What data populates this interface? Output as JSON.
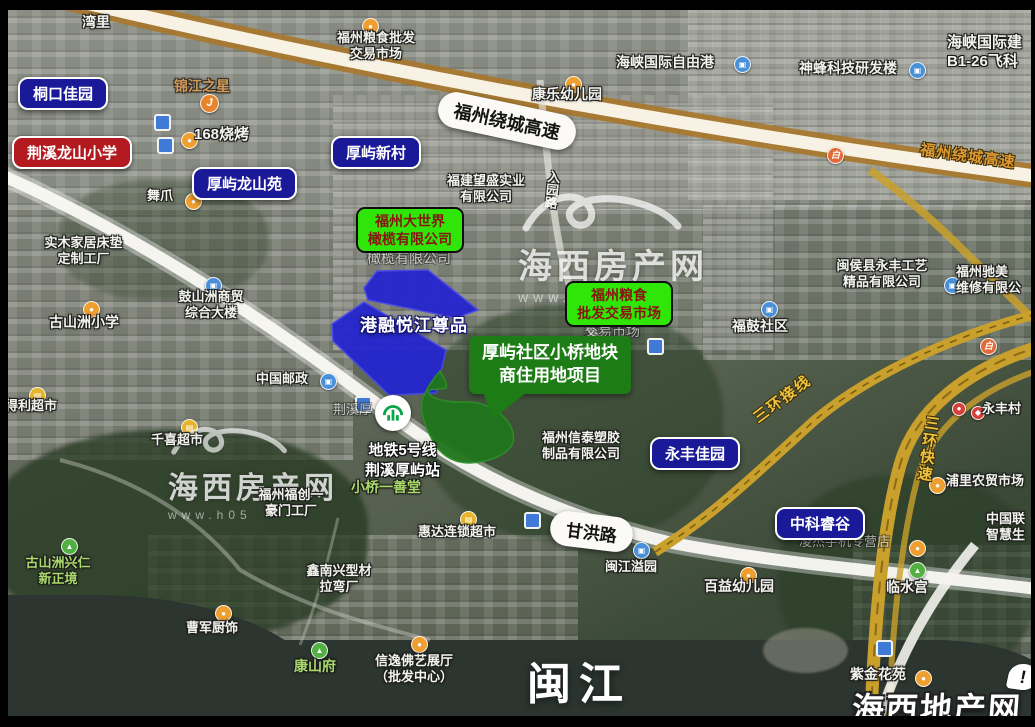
{
  "annotations": {
    "pills_blue": [
      "桐口佳园",
      "厚屿新村",
      "厚屿龙山苑",
      "永丰佳园",
      "中科睿谷"
    ],
    "pills_red": [
      "荆溪龙山小学"
    ],
    "green_labels": [
      {
        "line1": "福州大世界",
        "line2": "橄榄有限公司"
      },
      {
        "line1": "福州粮食",
        "line2": "批发交易市场"
      }
    ],
    "callout": {
      "line1": "厚屿社区小桥地块",
      "line2": "商住用地项目"
    },
    "parcel_label": "港融悦江尊品"
  },
  "metro": {
    "line1": "地铁5号线",
    "line2": "荆溪厚屿站"
  },
  "roads": {
    "raocheng_pill": "福州绕城高速",
    "raocheng_side": "福州绕城高速",
    "ganhong": "甘洪路",
    "sanhuan_jiexian": "三环接线",
    "sanhuan_kuaisu": "三环快速",
    "ruyuan": "入园路"
  },
  "river_label": "闽江",
  "map_labels": [
    {
      "t1": "湾里"
    },
    {
      "t1": "福州粮食批发",
      "t2": "交易市场"
    },
    {
      "t1": "康乐幼儿园"
    },
    {
      "t1": "海峡国际自由港"
    },
    {
      "t1": "神蜂科技研发楼"
    },
    {
      "t1": "海峡国际建",
      "t2": "B1-26飞科"
    },
    {
      "t1": "锦江之星"
    },
    {
      "t1": "168烧烤"
    },
    {
      "t1": "舞爪"
    },
    {
      "t1": "福建望盛实业",
      "t2": "有限公司"
    },
    {
      "t1": "实木家居床垫",
      "t2": "定制工厂"
    },
    {
      "t1": "古山洲小学"
    },
    {
      "t1": "鼓山洲商贸",
      "t2": "综合大楼"
    },
    {
      "t1": "中国邮政"
    },
    {
      "t1": "洲得利超市"
    },
    {
      "t1": "千喜超市"
    },
    {
      "t1": "福州福创一",
      "t2": "豪门工厂"
    },
    {
      "t1": "小桥一善堂"
    },
    {
      "t1": "惠达连锁超市"
    },
    {
      "t1": "鑫南兴型材",
      "t2": "拉弯厂"
    },
    {
      "t1": "古山洲兴仁",
      "t2": "新正境"
    },
    {
      "t1": "曹军厨饰"
    },
    {
      "t1": "康山府"
    },
    {
      "t1": "信逸佛艺展厅",
      "t2": "（批发中心）"
    },
    {
      "t1": "福州信泰塑胶",
      "t2": "制品有限公司"
    },
    {
      "t1": "闽江溢园"
    },
    {
      "t1": "百益幼儿园"
    },
    {
      "t1": "闽侯县永丰工艺",
      "t2": "精品有限公司"
    },
    {
      "t1": "福州驰美",
      "t2": "维修有限公"
    },
    {
      "t1": "福鼓社区"
    },
    {
      "t1": "永丰村"
    },
    {
      "t1": "浦里农贸市场"
    },
    {
      "t1": "凌杰手机专营店"
    },
    {
      "t1": "临水宫"
    },
    {
      "t1": "紫金花苑"
    },
    {
      "t1": "中国联",
      "t2": "智慧生"
    },
    {
      "t1": "橄榄有限公司"
    },
    {
      "t1": "交易市场"
    },
    {
      "t1": "荆溪厚"
    }
  ],
  "watermarks": {
    "center": {
      "title": "海西房产网",
      "url": "www.h0591"
    },
    "left": {
      "title": "海西房产网",
      "url": "www.h05"
    },
    "corner": {
      "title": "海西地产网",
      "badge": "!"
    }
  },
  "icons": {
    "dot": "●",
    "cart": "▤",
    "mail": "▣",
    "tri": "▲",
    "toll": "白",
    "hotel": "J",
    "diamond": "◆"
  },
  "colors": {
    "pill_blue": "#1a1a99",
    "pill_red": "#b31a20",
    "green_label_bg": "#2fe608",
    "green_label_text": "#8a1410",
    "callout_green": "#1d7c15",
    "parcel_blue": "#2525cf",
    "parcel_green": "#20761c",
    "road_yellow": "#c9a02c"
  }
}
